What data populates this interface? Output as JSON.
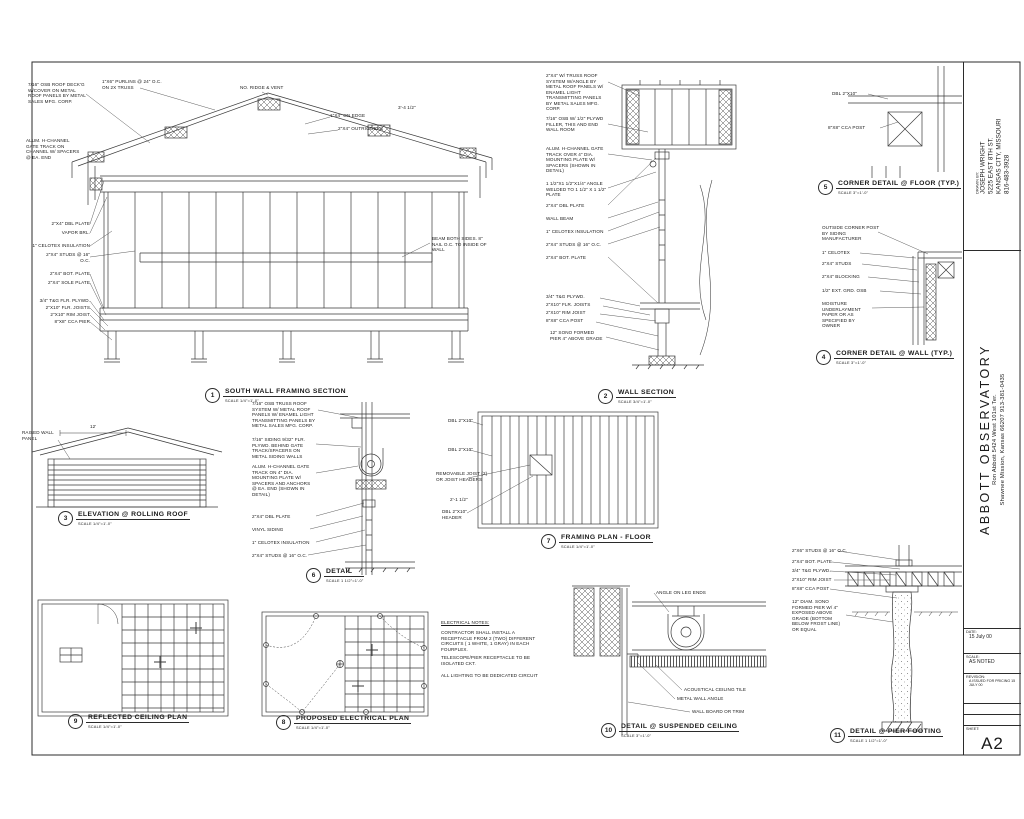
{
  "sheet": {
    "background": "#ffffff",
    "line_color": "#3a3a3a",
    "sheet_number": "A2"
  },
  "title_block": {
    "drawn_by_label": "DRAWN BY:",
    "drawn_by_lines": [
      "JOSEPH WRIGHT",
      "5225 EAST 8TH ST.",
      "KANSAS CITY, MISSOURI",
      "816-483-3928"
    ],
    "project_title": "ABBOTT  OBSERVATORY",
    "project_line1": "Ron Abbott  5424 West 101st Ter.",
    "project_line2": "Shawnee Mission, Kansas  66207   913-381-0435",
    "date_label": "DATE:",
    "date": "15 July 00",
    "scale_label": "SCALE:",
    "scale": "AS NOTED",
    "revision_label": "REVISION:",
    "revision": "A  ISSUED FOR PRICING  15 JULY 00",
    "sheet_label": "SHEET:",
    "sheet_number": "A2"
  },
  "detail_titles": [
    {
      "num": "1",
      "label": "SOUTH WALL FRAMING SECTION",
      "scale": "SCALE  1/4\"=1'-0\"",
      "x": 205,
      "y": 388
    },
    {
      "num": "2",
      "label": "WALL SECTION",
      "scale": "SCALE  3/4\"=1'-0\"",
      "x": 598,
      "y": 389
    },
    {
      "num": "3",
      "label": "ELEVATION @ ROLLING ROOF",
      "scale": "SCALE  1/4\"=1'-0\"",
      "x": 58,
      "y": 511
    },
    {
      "num": "4",
      "label": "CORNER DETAIL @ WALL (TYP.)",
      "scale": "SCALE  3\"=1'-0\"",
      "x": 816,
      "y": 350
    },
    {
      "num": "5",
      "label": "CORNER DETAIL @ FLOOR (TYP.)",
      "scale": "SCALE  3\"=1'-0\"",
      "x": 818,
      "y": 180
    },
    {
      "num": "6",
      "label": "DETAIL",
      "scale": "SCALE  1 1/2\"=1'-0\"",
      "x": 306,
      "y": 568
    },
    {
      "num": "7",
      "label": "FRAMING PLAN -  FLOOR",
      "scale": "SCALE  1/4\"=1'-0\"",
      "x": 541,
      "y": 534
    },
    {
      "num": "8",
      "label": "PROPOSED ELECTRICAL PLAN",
      "scale": "SCALE  1/4\"=1'-0\"",
      "x": 276,
      "y": 715
    },
    {
      "num": "9",
      "label": "REFLECTED CEILING PLAN",
      "scale": "SCALE  1/4\"=1'-0\"",
      "x": 68,
      "y": 714
    },
    {
      "num": "10",
      "label": "DETAIL @ SUSPENDED CEILING",
      "scale": "SCALE  3\"=1'-0\"",
      "x": 601,
      "y": 723
    },
    {
      "num": "11",
      "label": "DETAIL @ PIER FOOTING",
      "scale": "SCALE  1 1/2\"=1'-0\"",
      "x": 830,
      "y": 728
    }
  ],
  "annotations": [
    {
      "text": "7/16\" OSB ROOF DECK'G W/COVER ON METAL ROOF PANELS BY METAL SALES MFG. CORP.",
      "x": 28,
      "y": 82,
      "w": 58,
      "cls": "wrap"
    },
    {
      "text": "1\"X6\" PURLINS @ 24\" O.C. ON 2X TRUSS",
      "x": 102,
      "y": 79,
      "w": 64,
      "cls": "wrap"
    },
    {
      "text": "NO. RIDGE & VENT",
      "x": 240,
      "y": 85
    },
    {
      "text": "1\"X4\" ON EDGE",
      "x": 330,
      "y": 113
    },
    {
      "text": "2\"X4\" OUTRIGGERS",
      "x": 338,
      "y": 126
    },
    {
      "text": "3'-4 1/2\"",
      "x": 398,
      "y": 105
    },
    {
      "text": "ALUM. H-CHANNEL GATE TRACK ON CHANNEL W/ SPACERS @ EA. END",
      "x": 26,
      "y": 138,
      "w": 56,
      "cls": "wrap"
    },
    {
      "text": "2\"X4\" DBL PLATE",
      "x": 28,
      "y": 221,
      "w": 62,
      "align": "right"
    },
    {
      "text": "VAPOR BRL.",
      "x": 28,
      "y": 230,
      "w": 62,
      "align": "right"
    },
    {
      "text": "1\" CELOTEX INSULATION",
      "x": 28,
      "y": 243,
      "w": 62,
      "align": "right"
    },
    {
      "text": "2\"X4\" STUDS @ 16\" O.C.",
      "x": 40,
      "y": 252,
      "w": 50,
      "align": "right",
      "cls": "wrap"
    },
    {
      "text": "2\"X4\" BOT. PLATE",
      "x": 28,
      "y": 271,
      "w": 62,
      "align": "right"
    },
    {
      "text": "2\"X4\" SOLE PLATE",
      "x": 28,
      "y": 280,
      "w": 62,
      "align": "right"
    },
    {
      "text": "3/4\" T&G FLR. PLYWD.",
      "x": 28,
      "y": 298,
      "w": 62,
      "align": "right"
    },
    {
      "text": "2\"X10\" FLR. JOISTS",
      "x": 28,
      "y": 305,
      "w": 62,
      "align": "right"
    },
    {
      "text": "2\"X10\" RIM JOIST",
      "x": 28,
      "y": 312,
      "w": 62,
      "align": "right"
    },
    {
      "text": "8\"X8\" CCA PIER",
      "x": 28,
      "y": 319,
      "w": 62,
      "align": "right"
    },
    {
      "text": "BEAM BOTH SIDES. 8\" NAIL O.C. TO INSIDE OF WALL",
      "x": 432,
      "y": 236,
      "w": 56,
      "cls": "wrap"
    },
    {
      "text": "2\"X4\" W/ TRUSS ROOF SYSTEM W/ANGLE BY METAL ROOF PANELS W/ ENAMEL LIGHT TRANSMITTING PANELS BY METAL SALES MFG. CORP.",
      "x": 546,
      "y": 73,
      "w": 62,
      "cls": "wrap"
    },
    {
      "text": "7/16\" OSB W/ 1/2\" PLYWD FILLER, THIS AND END WALL ROOM",
      "x": 546,
      "y": 116,
      "w": 58,
      "cls": "wrap"
    },
    {
      "text": "ALUM. H-CHANNEL GATE TRACK OVER 4\" DIA. MOUNTING PLATE W/ SPACERS (SHOWN IN DETAIL)",
      "x": 546,
      "y": 146,
      "w": 60,
      "cls": "wrap"
    },
    {
      "text": "1 1/2\"X1 1/2\"X1/4\" ANGLE WELDED TO 1 1/2\" X 1 1/2\" PLATE",
      "x": 546,
      "y": 181,
      "w": 62,
      "cls": "wrap"
    },
    {
      "text": "2\"X4\" DBL PLATE",
      "x": 546,
      "y": 203
    },
    {
      "text": "WALL BEAM",
      "x": 546,
      "y": 216
    },
    {
      "text": "1\" CELOTEX INSULATION",
      "x": 546,
      "y": 229
    },
    {
      "text": "2\"X4\" STUDS @ 16\" O.C.",
      "x": 546,
      "y": 242
    },
    {
      "text": "2\"X4\" BOT. PLATE",
      "x": 546,
      "y": 255
    },
    {
      "text": "3/4\" T&G PLYWD.",
      "x": 546,
      "y": 294
    },
    {
      "text": "2\"X10\" FLR. JOISTS",
      "x": 546,
      "y": 302
    },
    {
      "text": "2\"X10\" RIM JOIST",
      "x": 546,
      "y": 310
    },
    {
      "text": "8\"X8\" CCA POST",
      "x": 546,
      "y": 318
    },
    {
      "text": "12\" SONO FORMED PIER 4\" ABOVE GRADE",
      "x": 550,
      "y": 330,
      "w": 54,
      "cls": "wrap"
    },
    {
      "text": "DBL 2\"X10\"",
      "x": 832,
      "y": 91
    },
    {
      "text": "8\"X8\" CCA POST",
      "x": 828,
      "y": 125
    },
    {
      "text": "OUTSIDE CORNER POST BY SIDING MANUFACTURER",
      "x": 822,
      "y": 225,
      "w": 58,
      "cls": "wrap"
    },
    {
      "text": "1\" CELOTEX",
      "x": 822,
      "y": 250
    },
    {
      "text": "2\"X4\" STUDS",
      "x": 822,
      "y": 261
    },
    {
      "text": "2\"X4\" BLOCKING",
      "x": 822,
      "y": 274
    },
    {
      "text": "1/2\" EXT. GRD. OSB",
      "x": 822,
      "y": 288
    },
    {
      "text": "MOISTURE UNDERLAYMENT PAPER OR AS SPECIFIED BY OWNER",
      "x": 822,
      "y": 301,
      "w": 52,
      "cls": "wrap"
    },
    {
      "text": "RAISED WALL PANEL",
      "x": 22,
      "y": 430,
      "w": 34,
      "cls": "wrap"
    },
    {
      "text": "12'",
      "x": 90,
      "y": 424
    },
    {
      "text": "7/16\" OSB TRUSS ROOF SYSTEM W/ METAL ROOF PANELS W/ ENAMEL LIGHT TRANSMITTING PANELS BY METAL SALES MFG. CORP.",
      "x": 252,
      "y": 401,
      "w": 66,
      "cls": "wrap"
    },
    {
      "text": "7/16\" SIDING 9/32\" FLR. PLYWD. BEHIND GATE TRACK/SPACERS ON METAL SIDING WALLS",
      "x": 252,
      "y": 437,
      "w": 64,
      "cls": "wrap"
    },
    {
      "text": "ALUM. H-CHANNEL GATE TRACK ON 4\" DIA. MOUNTING PLATE W/ SPACERS AND ANCHORS @ EA. END (SHOWN IN DETAIL)",
      "x": 252,
      "y": 464,
      "w": 64,
      "cls": "wrap"
    },
    {
      "text": "2\"X4\" DBL PLATE",
      "x": 252,
      "y": 514
    },
    {
      "text": "VINYL SIDING",
      "x": 252,
      "y": 527
    },
    {
      "text": "1\" CELOTEX INSULATION",
      "x": 252,
      "y": 540
    },
    {
      "text": "2\"X4\" STUDS @ 16\" O.C.",
      "x": 252,
      "y": 553
    },
    {
      "text": "DBL 2\"X10\"",
      "x": 448,
      "y": 418
    },
    {
      "text": "DBL 2\"X10\"",
      "x": 448,
      "y": 447
    },
    {
      "text": "REMOVABLE JOIST (2) OR JOIST HEADERS",
      "x": 436,
      "y": 471,
      "w": 52,
      "cls": "wrap"
    },
    {
      "text": "2'-1 1/2\"",
      "x": 450,
      "y": 497
    },
    {
      "text": "DBL 2\"X10\" HEADER",
      "x": 442,
      "y": 509,
      "w": 42,
      "cls": "wrap"
    },
    {
      "text": "ELECTRICAL NOTES:",
      "x": 441,
      "y": 620,
      "cls": "und"
    },
    {
      "text": "CONTRACTOR SHALL INSTALL A RECEPTACLE FROM 2 (TWO) DIFFERENT CIRCUITS ( 1 WHITE, 1 GRAY) IN EACH FOURPLEX.",
      "x": 441,
      "y": 630,
      "w": 102,
      "cls": "wrap"
    },
    {
      "text": "TELESCOPE/PIER RECEPTACLE TO BE ISOLATED CKT.",
      "x": 441,
      "y": 655,
      "w": 100,
      "cls": "wrap"
    },
    {
      "text": "ALL LIGHTING TO BE DEDICATED CIRCUIT",
      "x": 441,
      "y": 673,
      "w": 102,
      "cls": "wrap"
    },
    {
      "text": "ANGLE ON LEG ENDS",
      "x": 656,
      "y": 590
    },
    {
      "text": "ACOUSTICAL CEILING TILE",
      "x": 684,
      "y": 687
    },
    {
      "text": "METAL WALL ANGLE",
      "x": 677,
      "y": 696
    },
    {
      "text": "WALL BOARD OR TRIM",
      "x": 692,
      "y": 709
    },
    {
      "text": "2\"X6\" STUDS @ 16\" O.C.",
      "x": 792,
      "y": 548
    },
    {
      "text": "2\"X4\" BOT. PLATE",
      "x": 792,
      "y": 559
    },
    {
      "text": "3/4\" T&G PLYWD.",
      "x": 792,
      "y": 568
    },
    {
      "text": "2\"X10\" RIM JOIST",
      "x": 792,
      "y": 577
    },
    {
      "text": "8\"X8\" CCA POST",
      "x": 792,
      "y": 586
    },
    {
      "text": "12\" DIAM. SONO FORMED PIER W/ 4\" EXPOSED ABOVE GRADE (BOTTOM BELOW FROST LINE) OR EQUAL",
      "x": 792,
      "y": 599,
      "w": 56,
      "cls": "wrap"
    }
  ]
}
